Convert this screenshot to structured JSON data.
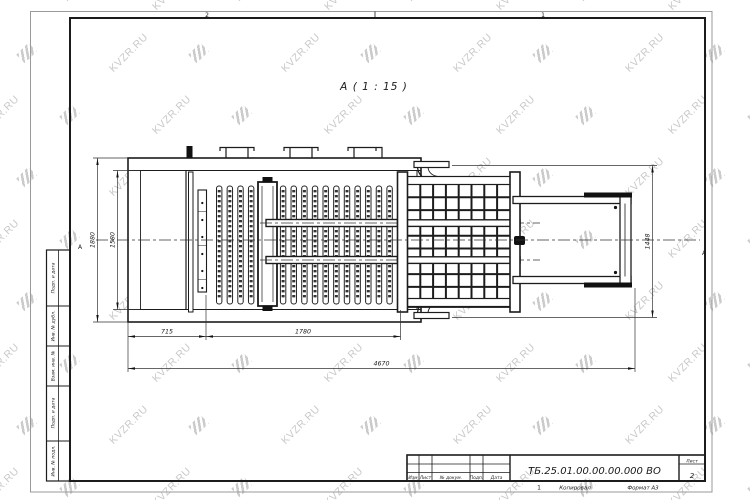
{
  "watermark": {
    "text": "KVZR.RU"
  },
  "sheet": {
    "view_label": "А ( 1 : 15 )",
    "zone_markers": {
      "top_left_zone": "2",
      "top_right_zone": "1",
      "left_row": "А",
      "right_row": "А",
      "bottom_zone": "1"
    }
  },
  "dimensions": {
    "overall_width": "1880",
    "inner_width": "1580",
    "left_section_length": "715",
    "grate_section_length": "1780",
    "total_length": "4670",
    "discharge_height": "1448"
  },
  "title_block": {
    "document_number": "ТБ.25.01.00.00.00.000 ВО",
    "revision_columns": [
      "Изм",
      "Лист",
      "№ докум.",
      "Подп.",
      "Дата"
    ],
    "sheet_label": "Лист",
    "sheet_number": "2",
    "copied_label": "Копировал",
    "format_label": "Формат А3"
  },
  "side_stamp": {
    "labels": [
      "Подп. и дата",
      "Инв. № дубл.",
      "Взам. инв. №",
      "Подп. и дата",
      "Инв. № подл."
    ]
  }
}
